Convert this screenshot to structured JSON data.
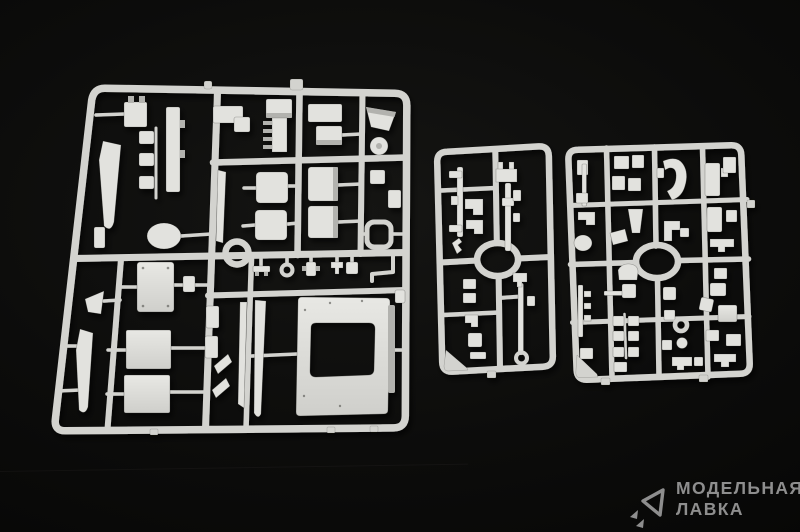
{
  "image": {
    "subject": "Photograph of three light grey injection-molded plastic model kit sprues with armored vehicle parts laid on a black background"
  },
  "colors": {
    "background": "#0c0c0b",
    "plastic": "#d3d3cf",
    "plastic_bright": "#e2e2de",
    "plastic_dark": "#b2b2ae",
    "watermark_gray": "#8e8e8e"
  },
  "watermark": {
    "icon": "paper-plane-triangle-icon",
    "line1": "МОДЕЛЬНАЯ",
    "line2": "ЛАВКА"
  },
  "sprues": [
    {
      "name": "large-sprue",
      "description": "large sprue with hull plates, hatches, grilles, boxes and a roof panel with rounded window opening"
    },
    {
      "name": "narrow-sprue",
      "description": "narrow sprue with gun rods and small fittings around a central oval ring"
    },
    {
      "name": "small-sprue",
      "description": "medium sprue with many small fittings arranged around a central oval ring"
    }
  ]
}
